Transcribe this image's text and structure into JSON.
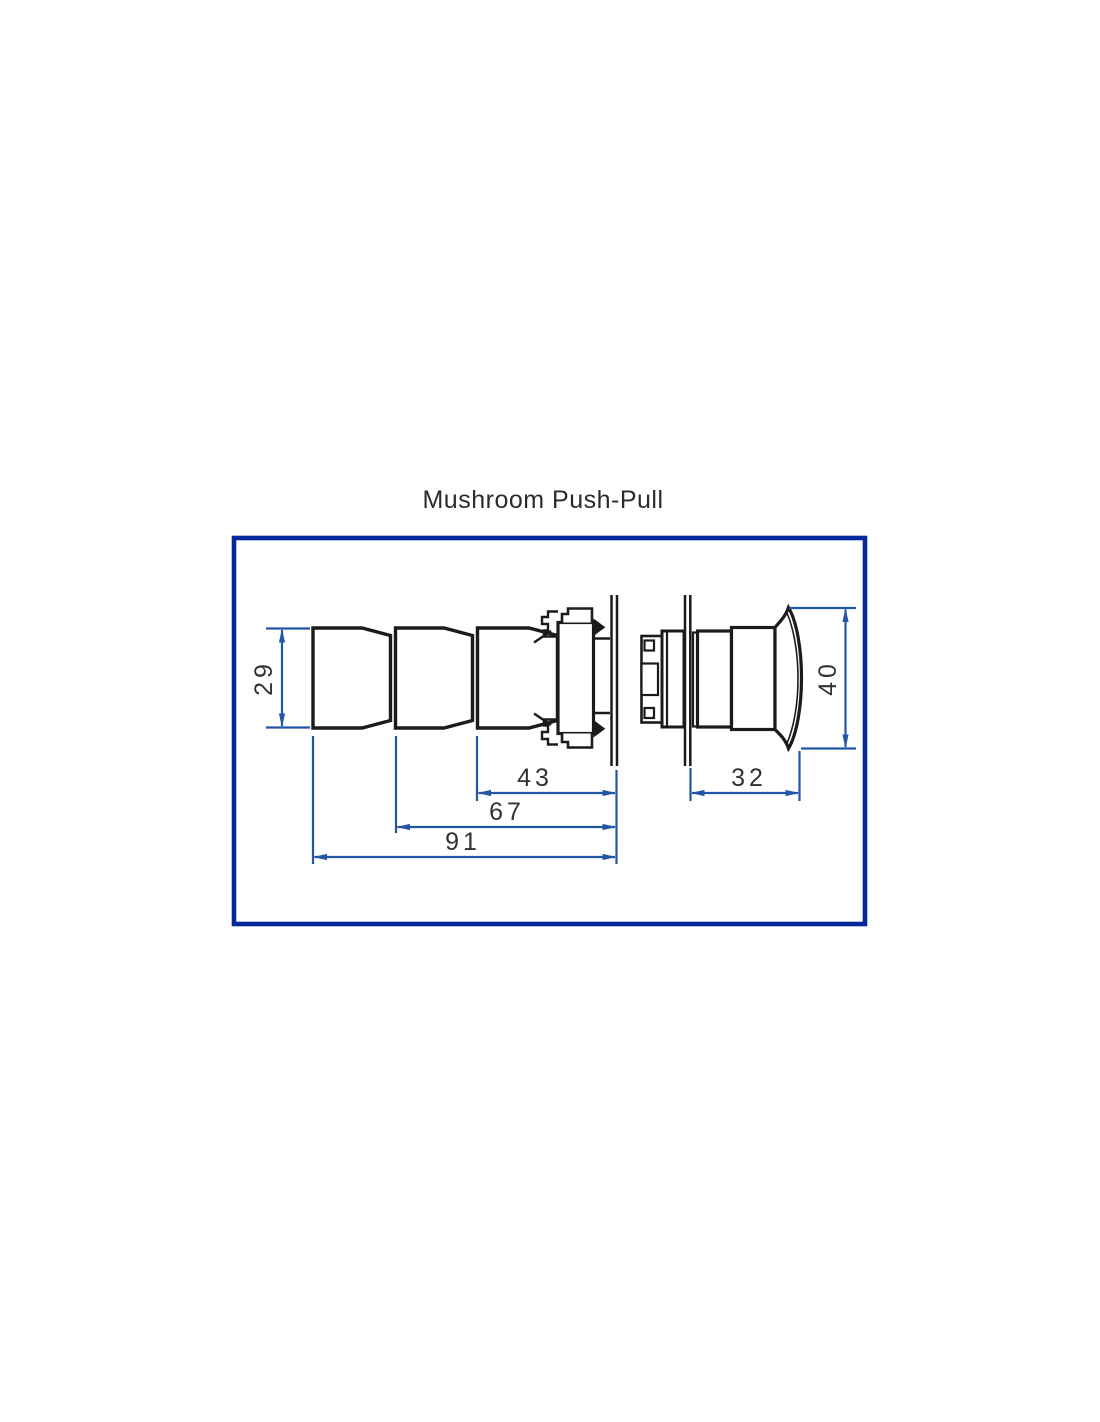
{
  "drawing": {
    "title": "Mushroom Push-Pull",
    "dims": {
      "body_diameter": "29",
      "head_diameter": "40",
      "len_operator": "43",
      "len_mid": "67",
      "len_total": "91",
      "head_length": "32"
    },
    "colors": {
      "frame_border": "#04289a",
      "dimension_line": "#2257a8",
      "drawing_line": "#1b1b1b",
      "dimension_text": "#323232",
      "background": "#ffffff"
    }
  }
}
